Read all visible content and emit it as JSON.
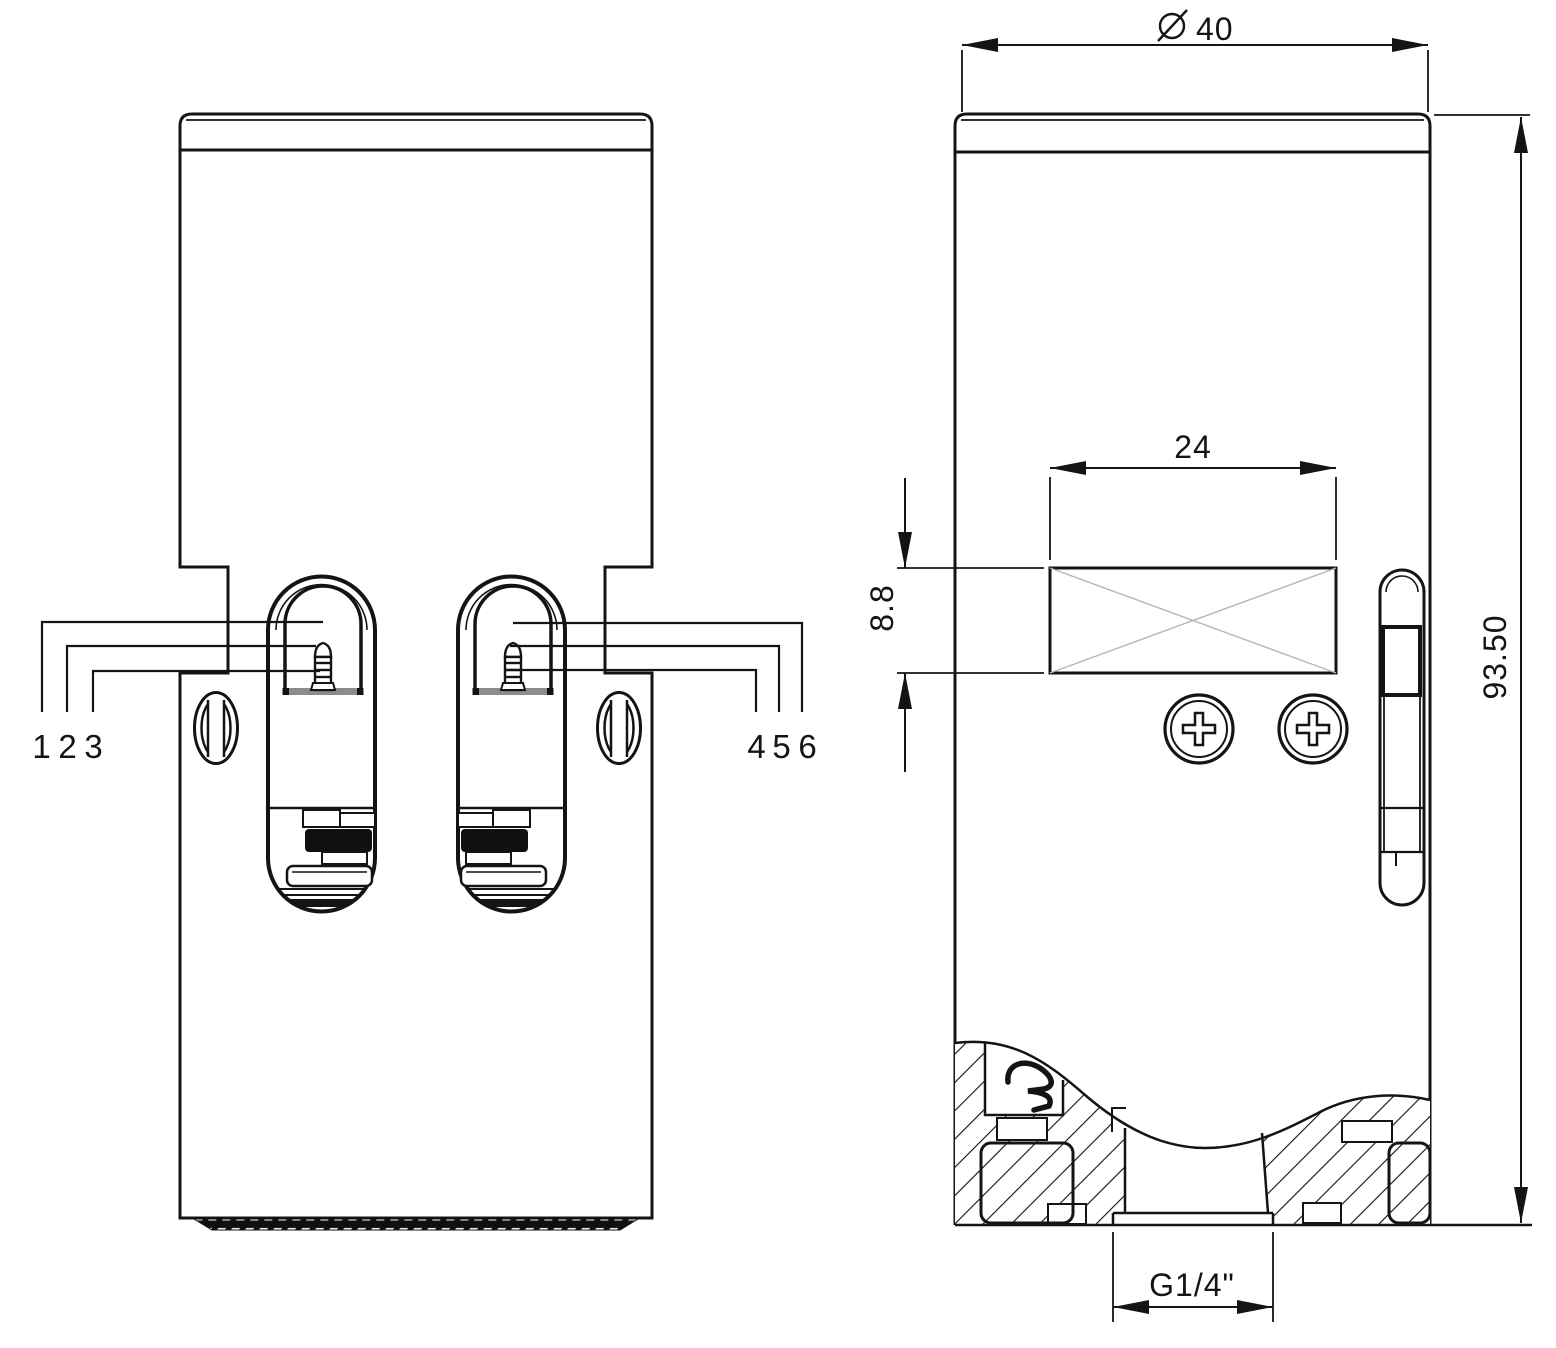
{
  "drawing": {
    "type": "technical-drawing",
    "background": "#ffffff",
    "line_color": "#141414",
    "views": {
      "left": "front-view",
      "right": "section-back-view"
    },
    "callouts": [
      "1",
      "2",
      "3",
      "4",
      "5",
      "6"
    ],
    "dimensions": {
      "diameter_symbol": "⌀",
      "diameter": "40",
      "slot_width": "24",
      "slot_height": "8.8",
      "overall_height": "93.50",
      "thread": "G1/4\""
    }
  }
}
